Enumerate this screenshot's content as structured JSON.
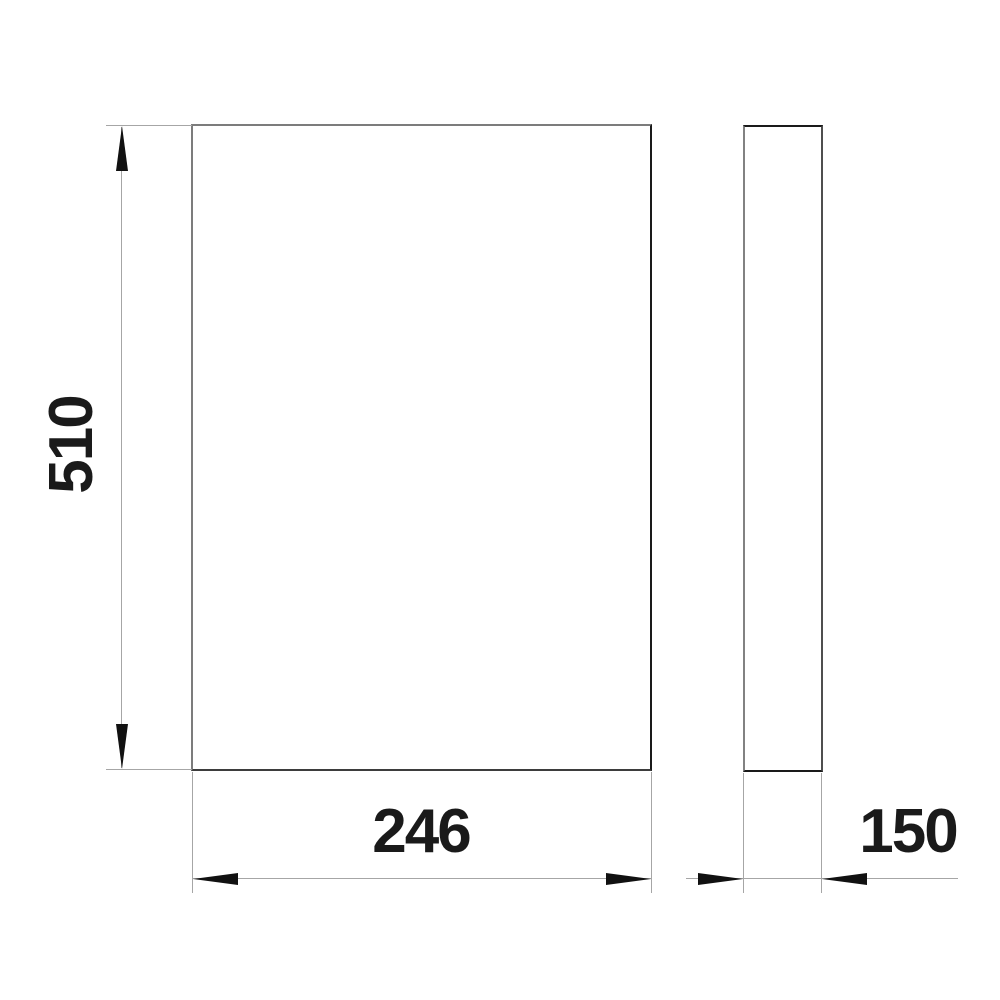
{
  "drawing": {
    "type": "technical-dimension-drawing",
    "views": {
      "front": "front-view",
      "side": "side-view"
    },
    "dimensions": {
      "height": {
        "value": "510",
        "orientation": "vertical"
      },
      "width": {
        "value": "246",
        "orientation": "horizontal"
      },
      "depth": {
        "value": "150",
        "orientation": "horizontal"
      }
    },
    "colors": {
      "background": "#ffffff",
      "outline_gray": "#7c7c7c",
      "outline_dark": "#1a1a1a",
      "dimension_line": "#a6a6a6",
      "arrow": "#111111",
      "text": "#1a1a1a"
    }
  }
}
